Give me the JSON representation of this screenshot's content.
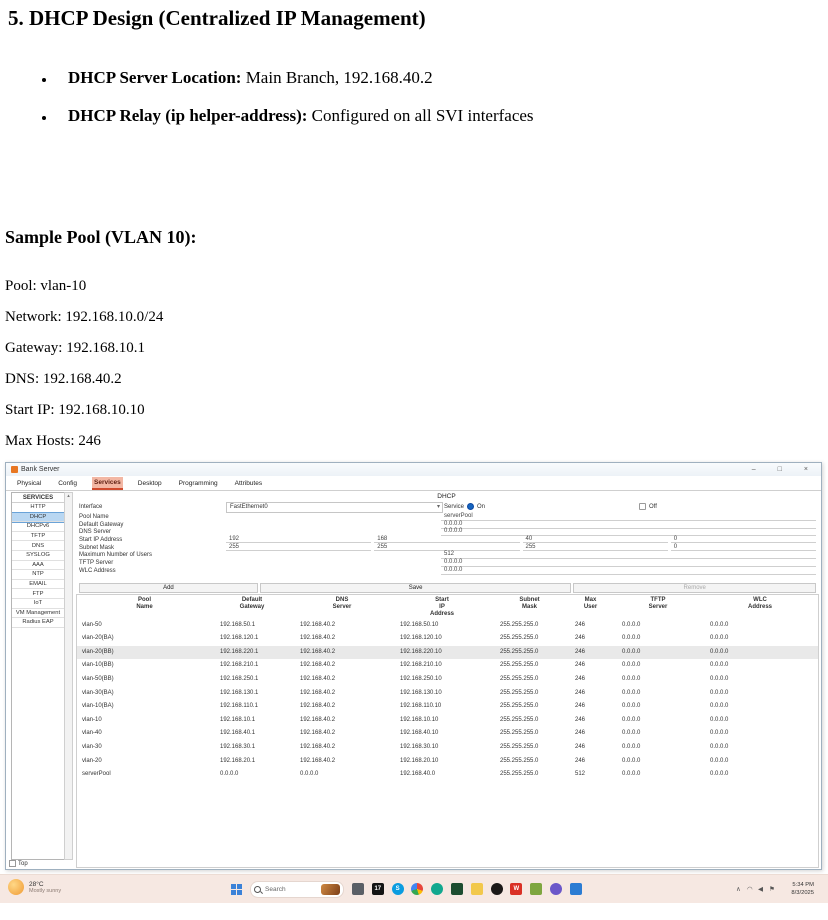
{
  "document": {
    "heading": "5. DHCP Design (Centralized IP Management)",
    "bullets": [
      {
        "label": "DHCP Server Location:",
        "text": " Main Branch, 192.168.40.2"
      },
      {
        "label": "DHCP Relay (ip helper-address):",
        "text": " Configured on all SVI interfaces"
      }
    ],
    "subheading": "Sample Pool (VLAN 10):",
    "pool_lines": [
      "Pool: vlan-10",
      "Network: 192.168.10.0/24",
      "Gateway: 192.168.10.1",
      "DNS: 192.168.40.2",
      "Start IP: 192.168.10.10",
      "Max Hosts: 246"
    ]
  },
  "window": {
    "title": "Bank Server",
    "controls": {
      "minimize": "–",
      "maximize": "□",
      "close": "×"
    },
    "tabs": [
      "Physical",
      "Config",
      "Services",
      "Desktop",
      "Programming",
      "Attributes"
    ],
    "active_tab": "Services",
    "sidebar": {
      "header": "SERVICES",
      "items": [
        "HTTP",
        "DHCP",
        "DHCPv6",
        "TFTP",
        "DNS",
        "SYSLOG",
        "AAA",
        "NTP",
        "EMAIL",
        "FTP",
        "IoT",
        "VM Management",
        "Radius EAP"
      ],
      "active": "DHCP"
    },
    "dhcp": {
      "panel_title": "DHCP",
      "interface_label": "Interface",
      "interface_value": "FastEthernet0",
      "service_label": "Service",
      "on_label": "On",
      "off_label": "Off",
      "service_state": "On",
      "fields": [
        {
          "label": "Pool Name",
          "value": "serverPool"
        },
        {
          "label": "Default Gateway",
          "value": "0.0.0.0"
        },
        {
          "label": "DNS Server",
          "value": "0.0.0.0"
        },
        {
          "label": "Start IP Address",
          "octets": [
            "192",
            "168",
            "40",
            "0"
          ]
        },
        {
          "label": "Subnet Mask",
          "octets": [
            "255",
            "255",
            "255",
            "0"
          ]
        },
        {
          "label": "Maximum Number of Users",
          "value": "512"
        },
        {
          "label": "TFTP Server",
          "value": "0.0.0.0"
        },
        {
          "label": "WLC Address",
          "value": "0.0.0.0"
        }
      ],
      "buttons": {
        "add": "Add",
        "save": "Save",
        "remove": "Remove"
      },
      "table": {
        "headers": [
          "Pool\nName",
          "Default\nGateway",
          "DNS\nServer",
          "Start\nIP\nAddress",
          "Subnet\nMask",
          "Max\nUser",
          "TFTP\nServer",
          "WLC\nAddress"
        ],
        "selected_row": 2,
        "rows": [
          [
            "vlan-50",
            "192.168.50.1",
            "192.168.40.2",
            "192.168.50.10",
            "255.255.255.0",
            "246",
            "0.0.0.0",
            "0.0.0.0"
          ],
          [
            "vlan-20(BA)",
            "192.168.120.1",
            "192.168.40.2",
            "192.168.120.10",
            "255.255.255.0",
            "246",
            "0.0.0.0",
            "0.0.0.0"
          ],
          [
            "vlan-20(BB)",
            "192.168.220.1",
            "192.168.40.2",
            "192.168.220.10",
            "255.255.255.0",
            "246",
            "0.0.0.0",
            "0.0.0.0"
          ],
          [
            "vlan-10(BB)",
            "192.168.210.1",
            "192.168.40.2",
            "192.168.210.10",
            "255.255.255.0",
            "246",
            "0.0.0.0",
            "0.0.0.0"
          ],
          [
            "vlan-50(BB)",
            "192.168.250.1",
            "192.168.40.2",
            "192.168.250.10",
            "255.255.255.0",
            "246",
            "0.0.0.0",
            "0.0.0.0"
          ],
          [
            "vlan-30(BA)",
            "192.168.130.1",
            "192.168.40.2",
            "192.168.130.10",
            "255.255.255.0",
            "246",
            "0.0.0.0",
            "0.0.0.0"
          ],
          [
            "vlan-10(BA)",
            "192.168.110.1",
            "192.168.40.2",
            "192.168.110.10",
            "255.255.255.0",
            "246",
            "0.0.0.0",
            "0.0.0.0"
          ],
          [
            "vlan-10",
            "192.168.10.1",
            "192.168.40.2",
            "192.168.10.10",
            "255.255.255.0",
            "246",
            "0.0.0.0",
            "0.0.0.0"
          ],
          [
            "vlan-40",
            "192.168.40.1",
            "192.168.40.2",
            "192.168.40.10",
            "255.255.255.0",
            "246",
            "0.0.0.0",
            "0.0.0.0"
          ],
          [
            "vlan-30",
            "192.168.30.1",
            "192.168.40.2",
            "192.168.30.10",
            "255.255.255.0",
            "246",
            "0.0.0.0",
            "0.0.0.0"
          ],
          [
            "vlan-20",
            "192.168.20.1",
            "192.168.40.2",
            "192.168.20.10",
            "255.255.255.0",
            "246",
            "0.0.0.0",
            "0.0.0.0"
          ],
          [
            "serverPool",
            "0.0.0.0",
            "0.0.0.0",
            "192.168.40.0",
            "255.255.255.0",
            "512",
            "0.0.0.0",
            "0.0.0.0"
          ]
        ]
      }
    },
    "bottom_checkbox_label": "Top",
    "scroll_up_glyph": "▴"
  },
  "taskbar": {
    "weather": {
      "temp": "28°C",
      "condition": "Mostly sunny"
    },
    "search_label": "Search",
    "icons": [
      {
        "name": "laptop-icon",
        "color": "#5a5f66",
        "shape": "square",
        "glyph": ""
      },
      {
        "name": "media-17-icon",
        "color": "#141414",
        "shape": "square",
        "glyph": "17"
      },
      {
        "name": "skype-icon",
        "color": "#0a9ce0",
        "shape": "circle",
        "glyph": "S"
      },
      {
        "name": "chrome-icon",
        "color": "multi",
        "shape": "circle",
        "glyph": ""
      },
      {
        "name": "edge-icon",
        "color": "#12a88f",
        "shape": "circle",
        "glyph": ""
      },
      {
        "name": "terminal-icon",
        "color": "#1d4d30",
        "shape": "square",
        "glyph": ""
      },
      {
        "name": "folder-icon",
        "color": "#f2c84b",
        "shape": "square",
        "glyph": ""
      },
      {
        "name": "github-icon",
        "color": "#1b1817",
        "shape": "circle",
        "glyph": ""
      },
      {
        "name": "wondershare-icon",
        "color": "#da3025",
        "shape": "square",
        "glyph": "W"
      },
      {
        "name": "packet-tracer-icon",
        "color": "#7ea63f",
        "shape": "square",
        "glyph": ""
      },
      {
        "name": "visual-studio-icon",
        "color": "#6b57c9",
        "shape": "circle",
        "glyph": ""
      },
      {
        "name": "mail-icon",
        "color": "#2b7cd3",
        "shape": "square",
        "glyph": ""
      }
    ],
    "tray_icons": [
      {
        "name": "tray-chevron-icon",
        "glyph": "∧"
      },
      {
        "name": "wifi-icon",
        "glyph": "◠"
      },
      {
        "name": "volume-icon",
        "glyph": "◀"
      },
      {
        "name": "flag-icon",
        "glyph": "⚑"
      }
    ],
    "tray_time": "5:34 PM",
    "tray_date": "8/3/2025"
  }
}
